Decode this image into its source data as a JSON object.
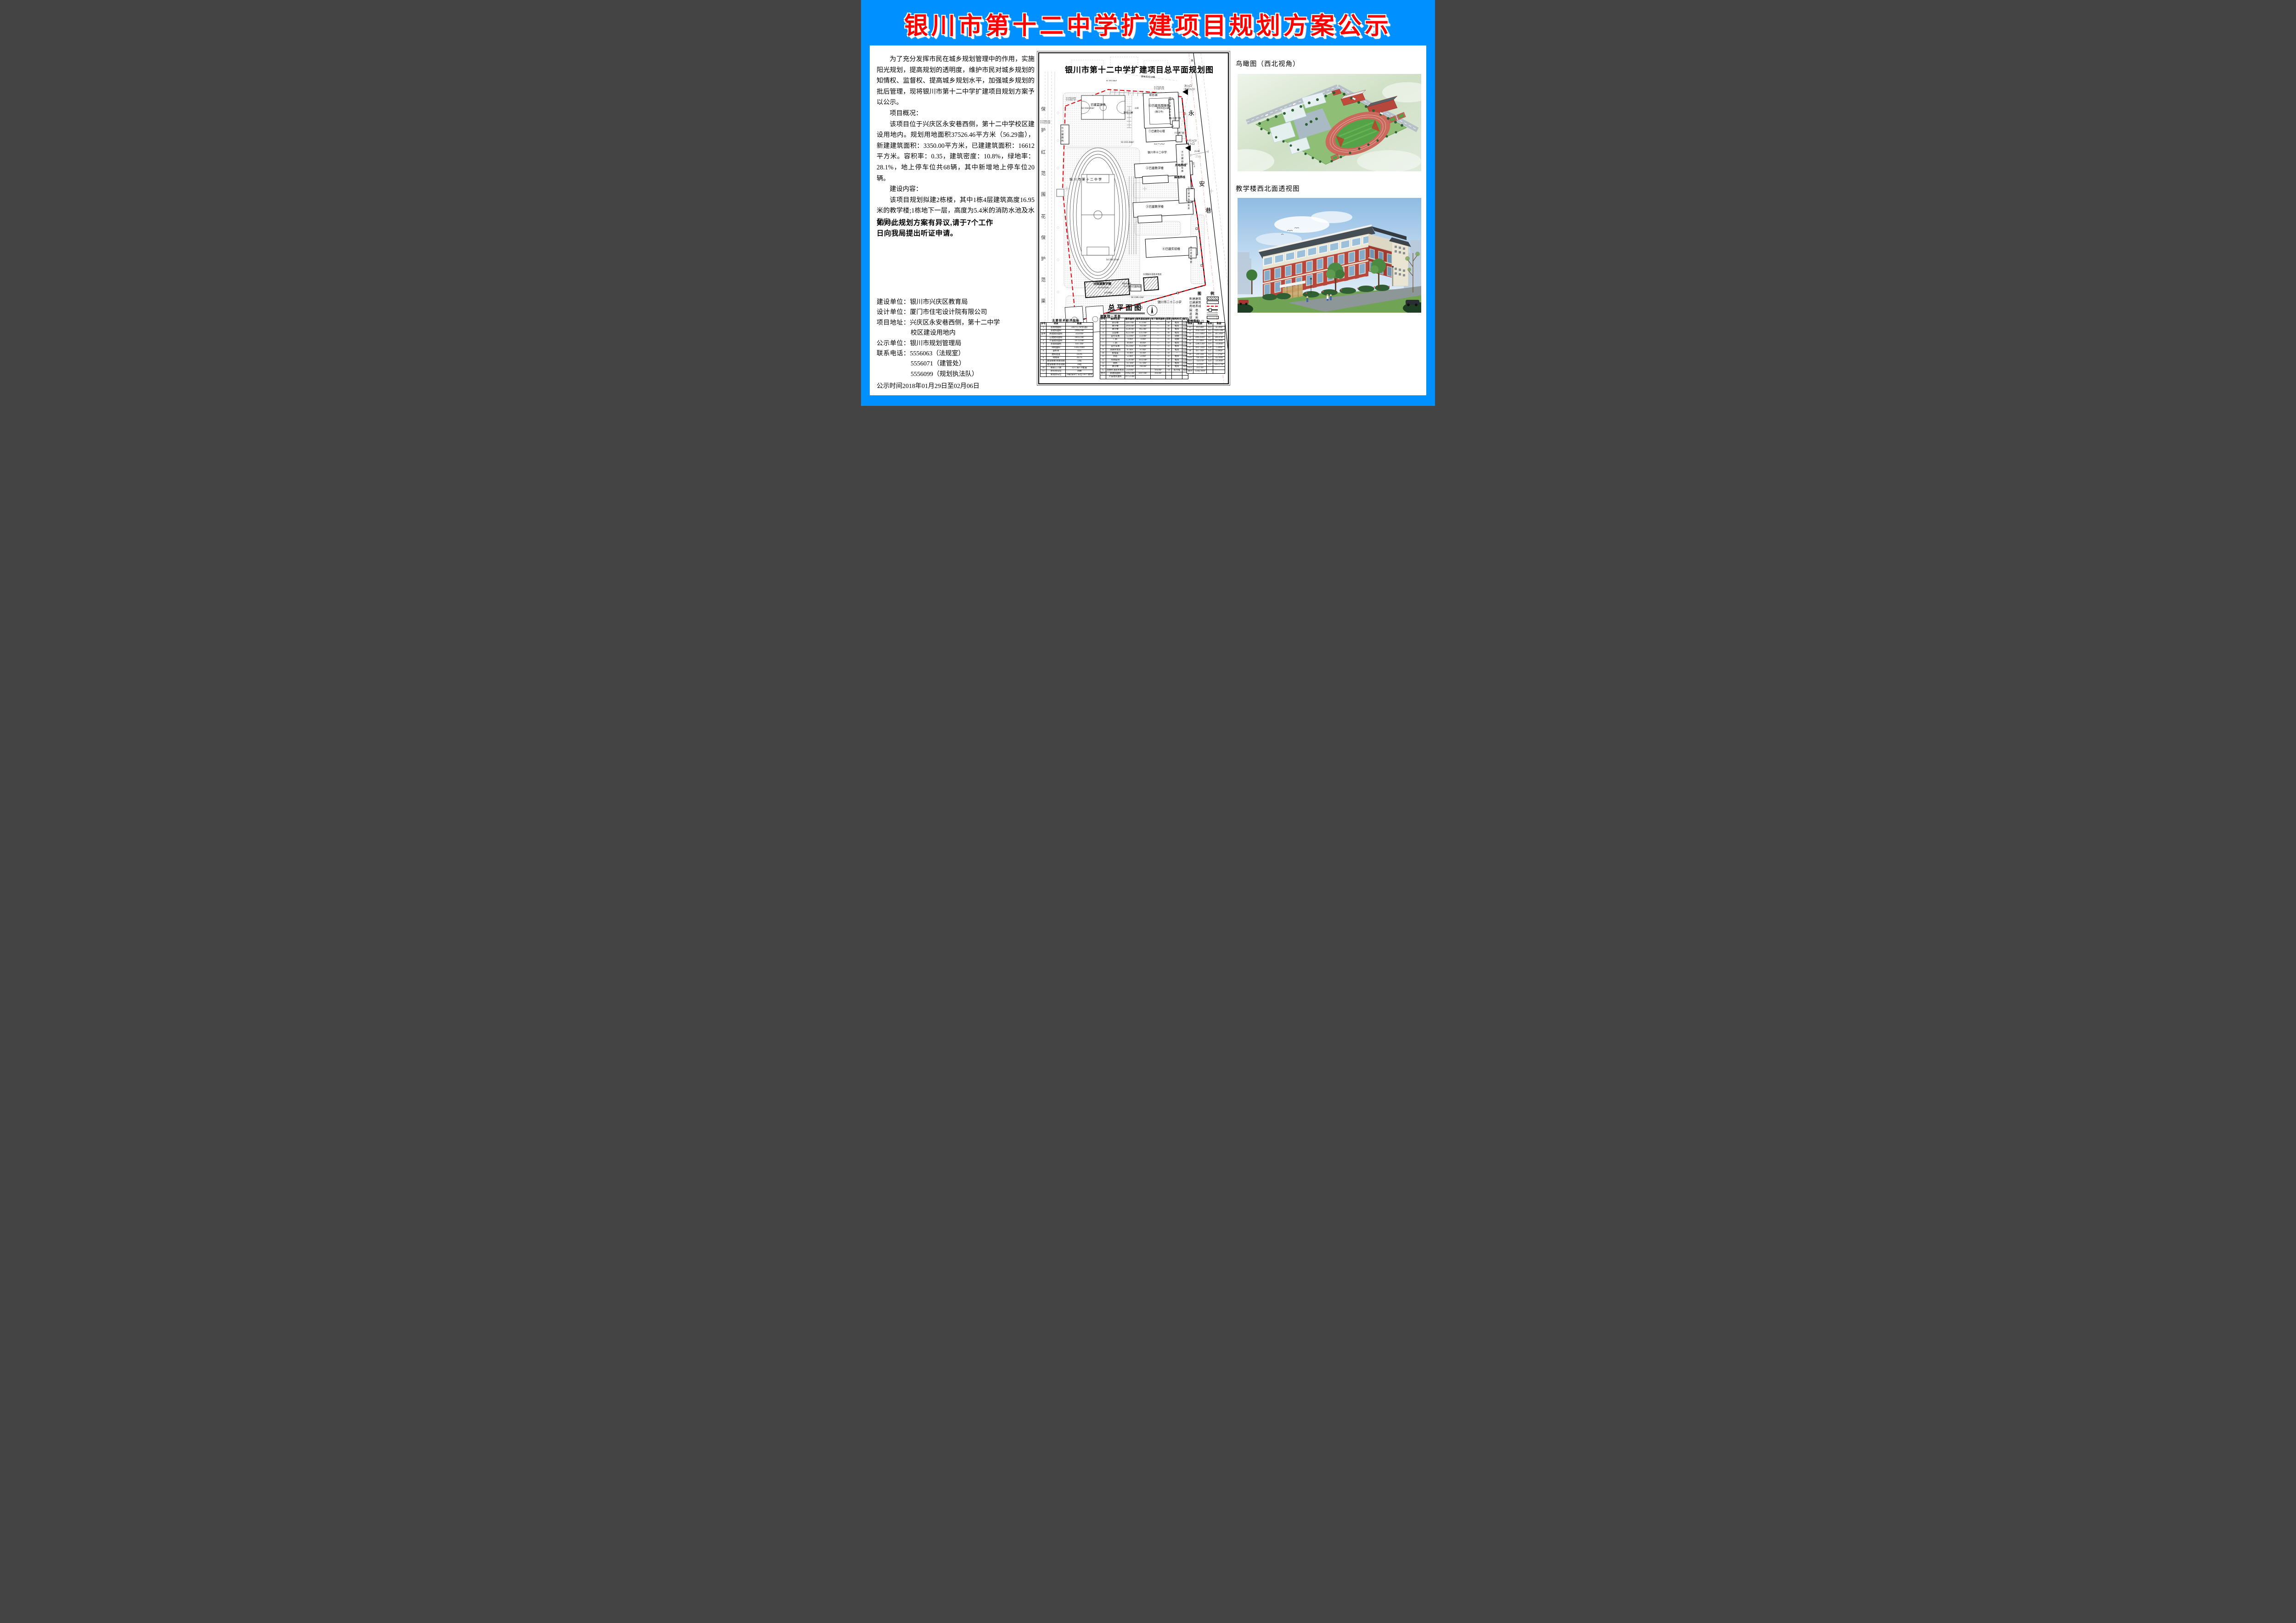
{
  "title": "银川市第十二中学扩建项目规划方案公示",
  "left_column": {
    "paragraphs": [
      "为了充分发挥市民在城乡规划管理中的作用，实施阳光规划，提高规划的透明度，维护市民对城乡规划的知情权、监督权、提高城乡规划水平，加强城乡规划的批后管理，现将银川市第十二中学扩建项目规划方案予以公示。",
      "项目概况：",
      "该项目位于兴庆区永安巷西侧，第十二中学校区建设用地内。规划用地面积37526.46平方米（56.29亩），新建建筑面积：3350.00平方米，已建建筑面积：16612平方米。容积率：0.35，建筑密度：10.8%，绿地率：28.1%，地上停车位共68辆，其中新增地上停车位20辆。",
      "建设内容：",
      "该项目规划拟建2栋楼，其中1栋4层建筑高度16.95米的教学楼;1栋地下一层，高度为5.4米的消防水池及水泵房。"
    ],
    "notice": "如对此规划方案有异议,请于7个工作日向我局提出听证申请。",
    "info_lines": [
      {
        "label": "建设单位：",
        "value": "银川市兴庆区教育局"
      },
      {
        "label": "设计单位：",
        "value": "厦门市住宅设计院有限公司"
      },
      {
        "label": "项目地址：",
        "value": "兴庆区永安巷西侧，第十二中学"
      },
      {
        "label": "",
        "value": "校区建设用地内"
      },
      {
        "label": "公示单位：",
        "value": "银川市规划管理局"
      },
      {
        "label": "联系电话：",
        "value": "5556063（法规室）"
      },
      {
        "label": "",
        "value": "5556071（建管处）"
      },
      {
        "label": "",
        "value": "5556099（规划执法队）"
      }
    ],
    "publicity_period": "公示时间2018年01月29日至02月06日"
  },
  "plan": {
    "labels": {
      "map_title": "银川市第十二中学扩建项目总平面规划图",
      "sub_title": "总平面图",
      "list_title": "建筑物一览表",
      "tech_title": "主要技术经济指标",
      "green_title": "绿地指标",
      "school_field": "银川市第十二中学",
      "school_inner": "银川市十二中学",
      "neighbor_school": "银川市二十二小学",
      "water": "水",
      "yong": "永",
      "an": "安",
      "xiang": "巷",
      "use_line": "用地界线",
      "wall_line": "围墙界线",
      "main_entry": "主入口",
      "main_entry_sub": "（人行入口）",
      "sec_entry": "次入口",
      "sec_entry_sub": "（车行入口）",
      "dim25": "25.00",
      "dim25m": "25m",
      "dim164": "164.70",
      "dim4": "4.00",
      "lvl": "(±0.000)",
      "b14h": "H=16.95m",
      "tank": "消防水箱间",
      "tankh": "H=21.0m",
      "b1": "①已建办公楼",
      "b2": "②已建教学楼",
      "b3": "③已建教学楼",
      "b4": "④已建实验楼",
      "b5": "⑤已建自行车棚",
      "b6": "⑥已建门房",
      "b7": "⑦已建门房",
      "b8": "⑧已建自行车库",
      "b9": "⑨已建消防水泵房",
      "b10": "⑩已建配电室",
      "b11": "⑪已建商店",
      "b12": "⑫已建风雨操场",
      "b13": "⑬已建厕所",
      "b14": "⑭拟建教学楼",
      "b15": "⑮消防水池及水泵房",
      "court": "已建篮球场",
      "constr": "(施工中)",
      "f1": "1F",
      "f2": "2F",
      "f4": "4F",
      "f5": "5F",
      "s1": "S1 391.64m²",
      "s2": "S2 1042.92m²",
      "s3": "S3 2355.04m²",
      "s4": "S4 2085.65m²",
      "s6": "S6 1286.12m²",
      "s22": "S22 77.27m²",
      "p38": "原有车位38辆",
      "p20": "原有车位20辆",
      "a15": "新增15辆",
      "a5": "新增5辆",
      "coord1a": "X=37634.859",
      "coord1b": "Y=51563.747",
      "coord2a": "X=37608.436",
      "coord2b": "Y=51513.546",
      "coord3a": "X=37649.286",
      "coord3b": "Y=51687.676"
    },
    "left_chars": [
      "保",
      "护",
      "红",
      "范",
      "围",
      "花",
      "保",
      "护",
      "范",
      "渠"
    ],
    "legend": {
      "title": "图　例",
      "items": [
        {
          "label": "新建建筑",
          "type": "hatched"
        },
        {
          "label": "已建建筑",
          "type": "outline"
        },
        {
          "label": "用地界线",
          "type": "reddash"
        },
        {
          "label": "围　墙",
          "type": "wall"
        },
        {
          "label": "道　路",
          "type": "road"
        },
        {
          "label": "绿　地",
          "type": "dots"
        },
        {
          "label": "学校出入口",
          "type": "tri"
        }
      ]
    },
    "tech_table": {
      "headers": [
        "序号",
        "项目",
        "数据"
      ],
      "rows": [
        [
          "1",
          "总用地面积",
          "56679.57m²(85亩)"
        ],
        [
          "2",
          "总建筑面积",
          "19962.0m²"
        ],
        [
          "其中",
          "新建建筑面积",
          "3350.0m²"
        ],
        [
          "",
          "已建建筑面积",
          "16612.0m²"
        ],
        [
          "3",
          "计容建筑面积",
          "19712.0m²"
        ],
        [
          "4",
          "总基底面积",
          "6107.0m²"
        ],
        [
          "5",
          "绿地面积",
          "15942.99m²"
        ],
        [
          "6",
          "容积率",
          "0.35"
        ],
        [
          "7",
          "建筑密度",
          "10.8%"
        ],
        [
          "8",
          "绿地率",
          "28.1%"
        ],
        [
          "9",
          "建设规模 新建班级",
          "12班"
        ],
        [
          "",
          "建设规模 原有班级",
          "30班"
        ],
        [
          "10",
          "教职工人数",
          "32人 按1:19配置"
        ],
        [
          "11",
          "原有停车位",
          "48辆"
        ],
        [
          "",
          "新增停车位",
          "20辆 按60个车位/100个教师"
        ]
      ]
    },
    "building_table": {
      "headers": [
        "序号",
        "建筑性质",
        "建筑面积",
        "建筑基底面积",
        "地下建筑面积",
        "层数",
        "结构形式",
        "备注"
      ],
      "rows": [
        [
          "1",
          "办公楼",
          "2247.0m²",
          "673.0m²",
          "—",
          "4F",
          "框架",
          "已建"
        ],
        [
          "2",
          "教学楼",
          "2910.0m²",
          "783.0m²",
          "—",
          "4F",
          "框架",
          "已建"
        ],
        [
          "3",
          "教学楼",
          "3528.0m²",
          "965.0m²",
          "—",
          "4F",
          "框架",
          "已建"
        ],
        [
          "4",
          "实验楼",
          "4525.0m²",
          "1515.0m²",
          "—",
          "4F",
          "框架",
          "已建"
        ],
        [
          "5",
          "自行车库",
          "553.0m²",
          "553.0m²",
          "—",
          "1F",
          "轻钢",
          "已建"
        ],
        [
          "6",
          "门房",
          "74.0m²",
          "74.0m²",
          "—",
          "1F",
          "轻钢",
          "已建"
        ],
        [
          "7",
          "门房",
          "46.0m²",
          "46.0m²",
          "—",
          "1F",
          "框架",
          "已建"
        ],
        [
          "8",
          "自行车库",
          "853.0m²",
          "853.0m²",
          "—",
          "1F",
          "框架",
          "已建"
        ],
        [
          "9",
          "消防水泵房",
          "87.0m²",
          "87.0m²",
          "—",
          "1F",
          "框架",
          "已建"
        ],
        [
          "10",
          "配电室",
          "91.0m²",
          "91.0m²",
          "—",
          "1F",
          "—",
          "已建"
        ],
        [
          "11",
          "商店",
          "53.0m²",
          "53.0m²",
          "—",
          "1F",
          "框架",
          "已建"
        ],
        [
          "12",
          "风雨操场",
          "1528.0m²",
          "1052.0m²",
          "—",
          "2F",
          "框架",
          "已建"
        ],
        [
          "13",
          "厕所",
          "117.0m²",
          "117.0m²",
          "—",
          "1F",
          "框架",
          "已建"
        ],
        [
          "14",
          "教学楼",
          "3100.0m²",
          "760.0m²",
          "—",
          "4F",
          "框架",
          "拟建"
        ],
        [
          "15",
          "消防水池及水泵房",
          "250.0m²",
          "-",
          "104.0m²",
          "-1F",
          "剪力墙",
          "拟建"
        ],
        [
          "合计",
          "总建筑面积",
          "19962.0m²",
          "6107.0m²",
          "104.0m²",
          "",
          "",
          ""
        ],
        [
          "",
          "计容建筑面积",
          "19712.0m²",
          "",
          "",
          "",
          "",
          ""
        ]
      ]
    },
    "green_table": {
      "headers": [
        "项目",
        "数据",
        "项目",
        "数据"
      ],
      "rows": [
        [
          "S1",
          "391.64m²",
          "S14",
          "42.39m²"
        ],
        [
          "S2",
          "1042.92m²",
          "S15",
          "1026.50m²"
        ],
        [
          "S3",
          "2355.04m²",
          "S16",
          "383.58m²"
        ],
        [
          "S4",
          "2085.65m²",
          "S17",
          "204.87m²"
        ],
        [
          "S5",
          "237.00m²",
          "S18",
          "493.09m²"
        ],
        [
          "S6",
          "1286.12m²",
          "S19",
          "710.89m²"
        ],
        [
          "S7",
          "1047.35m²",
          "S20",
          "72.89m²"
        ],
        [
          "S8",
          "497.76m²",
          "S21",
          "13.88m²"
        ],
        [
          "S9",
          "509.13m²",
          "S22",
          "77.27m²"
        ],
        [
          "S10",
          "766.32m²",
          "S23",
          "142.69m²"
        ],
        [
          "S11",
          "742.67m²",
          "S24",
          "724.99m²"
        ],
        [
          "S12",
          "56.91m²",
          "S25",
          "1012.27m²"
        ],
        [
          "S13",
          "19.17m²",
          "",
          ""
        ],
        [
          "合计",
          "15942.99m²",
          "",
          ""
        ]
      ]
    }
  },
  "right_column": {
    "aerial_label": "鸟瞰图（西北视角）",
    "perspective_label": "教学楼西北面透视图"
  },
  "colors": {
    "frame_blue": "#0090ff",
    "title_red": "#ff0000",
    "boundary_red": "#e8000a",
    "track_red": "#c96a5c",
    "field_green": "#55a348",
    "brick_red": "#b5473c"
  }
}
